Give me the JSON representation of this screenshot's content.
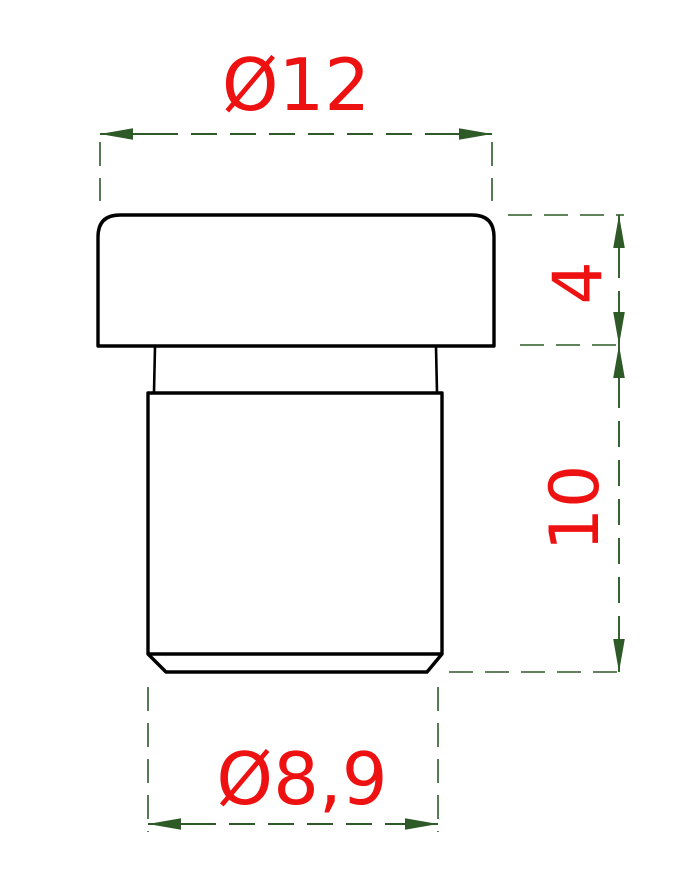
{
  "drawing": {
    "kind": "technical-dimension-drawing",
    "subject": "flanged cylindrical plug, side view",
    "dimensions": [
      {
        "id": "top-diameter",
        "label": "Ø12",
        "value": 12,
        "type": "diameter",
        "orientation": "horizontal"
      },
      {
        "id": "head-height",
        "label": "4",
        "value": 4,
        "type": "length",
        "orientation": "vertical"
      },
      {
        "id": "body-height",
        "label": "10",
        "value": 10,
        "type": "length",
        "orientation": "vertical"
      },
      {
        "id": "bottom-diameter",
        "label": "Ø8,9",
        "value": 8.9,
        "type": "diameter",
        "orientation": "horizontal"
      }
    ],
    "colors": {
      "dimension_text": "#ee1111",
      "dimension_line": "#2d5a27",
      "part_outline": "#000000",
      "background": "#ffffff"
    }
  }
}
